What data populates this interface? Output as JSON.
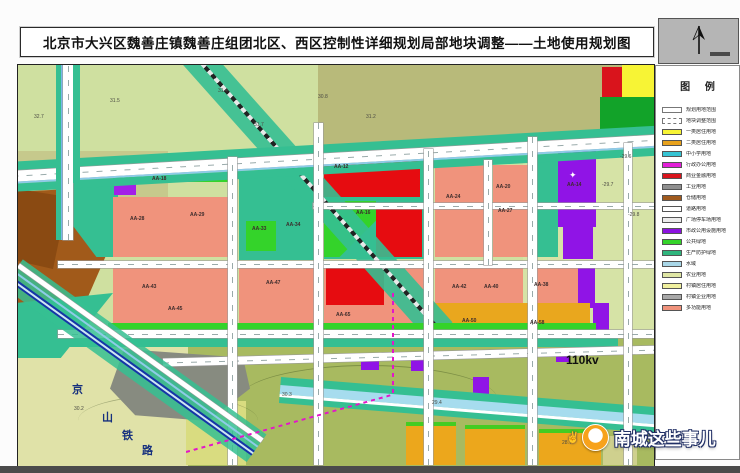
{
  "title": "北京市大兴区魏善庄镇魏善庄组团北区、西区控制性详细规划局部地块调整——土地使用规划图",
  "legend": {
    "title": "图 例",
    "items": [
      {
        "label": "规划用地范围",
        "swatch": "outline-solid",
        "color": "#ffffff"
      },
      {
        "label": "地块调整范围",
        "swatch": "outline-dashed",
        "color": "#ffffff"
      },
      {
        "label": "一类居住用地",
        "swatch": "fill",
        "color": "#f7f435"
      },
      {
        "label": "二类居住用地",
        "swatch": "fill",
        "color": "#e8a21d"
      },
      {
        "label": "中小学用地",
        "swatch": "fill",
        "color": "#35c4d4"
      },
      {
        "label": "行政办公用地",
        "swatch": "fill",
        "color": "#e320d8"
      },
      {
        "label": "商业金融用地",
        "swatch": "fill",
        "color": "#d9141c"
      },
      {
        "label": "工业用地",
        "swatch": "fill",
        "color": "#8f8f8f"
      },
      {
        "label": "仓储用地",
        "swatch": "fill",
        "color": "#a05a1e"
      },
      {
        "label": "道路用地",
        "swatch": "fill",
        "color": "#ffffff"
      },
      {
        "label": "广场停车场用地",
        "swatch": "fill",
        "color": "#ececec"
      },
      {
        "label": "市政公用设施用地",
        "swatch": "fill",
        "color": "#8c12e0"
      },
      {
        "label": "公共绿地",
        "swatch": "fill",
        "color": "#34d32a"
      },
      {
        "label": "生产防护绿地",
        "swatch": "fill",
        "color": "#2fb57d"
      },
      {
        "label": "水域",
        "swatch": "fill",
        "color": "#a9d7e8"
      },
      {
        "label": "农业用地",
        "swatch": "fill",
        "color": "#dfe6a4"
      },
      {
        "label": "村镇居住用地",
        "swatch": "fill",
        "color": "#f0f09e"
      },
      {
        "label": "村镇企业用地",
        "swatch": "fill",
        "color": "#a8a8a8"
      },
      {
        "label": "多功能用地",
        "swatch": "fill",
        "color": "#f0937c"
      }
    ]
  },
  "map": {
    "power_label": "110kv",
    "railway": {
      "name": "京山铁路",
      "chars": [
        "京",
        "山",
        "铁",
        "路"
      ],
      "positions": [
        [
          54,
          316
        ],
        [
          84,
          344
        ],
        [
          104,
          362
        ],
        [
          124,
          377
        ]
      ]
    },
    "parcel_labels": [
      {
        "text": "AA-18",
        "x": 134,
        "y": 112
      },
      {
        "text": "AA-28",
        "x": 112,
        "y": 152
      },
      {
        "text": "AA-29",
        "x": 172,
        "y": 148
      },
      {
        "text": "AA-33",
        "x": 234,
        "y": 162
      },
      {
        "text": "AA-34",
        "x": 268,
        "y": 158
      },
      {
        "text": "AA-12",
        "x": 316,
        "y": 100
      },
      {
        "text": "AA-16",
        "x": 338,
        "y": 146
      },
      {
        "text": "AA-24",
        "x": 428,
        "y": 130
      },
      {
        "text": "AA-20",
        "x": 478,
        "y": 120
      },
      {
        "text": "AA-27",
        "x": 480,
        "y": 144
      },
      {
        "text": "AA-14",
        "x": 549,
        "y": 118
      },
      {
        "text": "AA-43",
        "x": 124,
        "y": 220
      },
      {
        "text": "AA-45",
        "x": 150,
        "y": 242
      },
      {
        "text": "AA-47",
        "x": 248,
        "y": 216
      },
      {
        "text": "AA-65",
        "x": 318,
        "y": 248
      },
      {
        "text": "AA-42",
        "x": 434,
        "y": 220
      },
      {
        "text": "AA-40",
        "x": 466,
        "y": 220
      },
      {
        "text": "AA-38",
        "x": 516,
        "y": 218
      },
      {
        "text": "AA-50",
        "x": 444,
        "y": 254
      },
      {
        "text": "AA-58",
        "x": 512,
        "y": 256
      }
    ],
    "elevation_labels": [
      {
        "text": "32.7",
        "x": 16,
        "y": 50
      },
      {
        "text": "31.5",
        "x": 92,
        "y": 34
      },
      {
        "text": "31.4",
        "x": 200,
        "y": 24
      },
      {
        "text": "31.7",
        "x": 236,
        "y": 58
      },
      {
        "text": "31.2",
        "x": 348,
        "y": 50
      },
      {
        "text": "30.8",
        "x": 300,
        "y": 30
      },
      {
        "text": "-29.6",
        "x": 602,
        "y": 90
      },
      {
        "text": "-29.7",
        "x": 584,
        "y": 118
      },
      {
        "text": "-29.8",
        "x": 610,
        "y": 148
      },
      {
        "text": "30.3",
        "x": 264,
        "y": 328
      },
      {
        "text": "29.4",
        "x": 414,
        "y": 336
      },
      {
        "text": "30.2",
        "x": 56,
        "y": 342
      },
      {
        "text": "28.7",
        "x": 544,
        "y": 376
      }
    ]
  },
  "watermark": {
    "text": "南城这些事儿",
    "hand_icon": "✌"
  }
}
